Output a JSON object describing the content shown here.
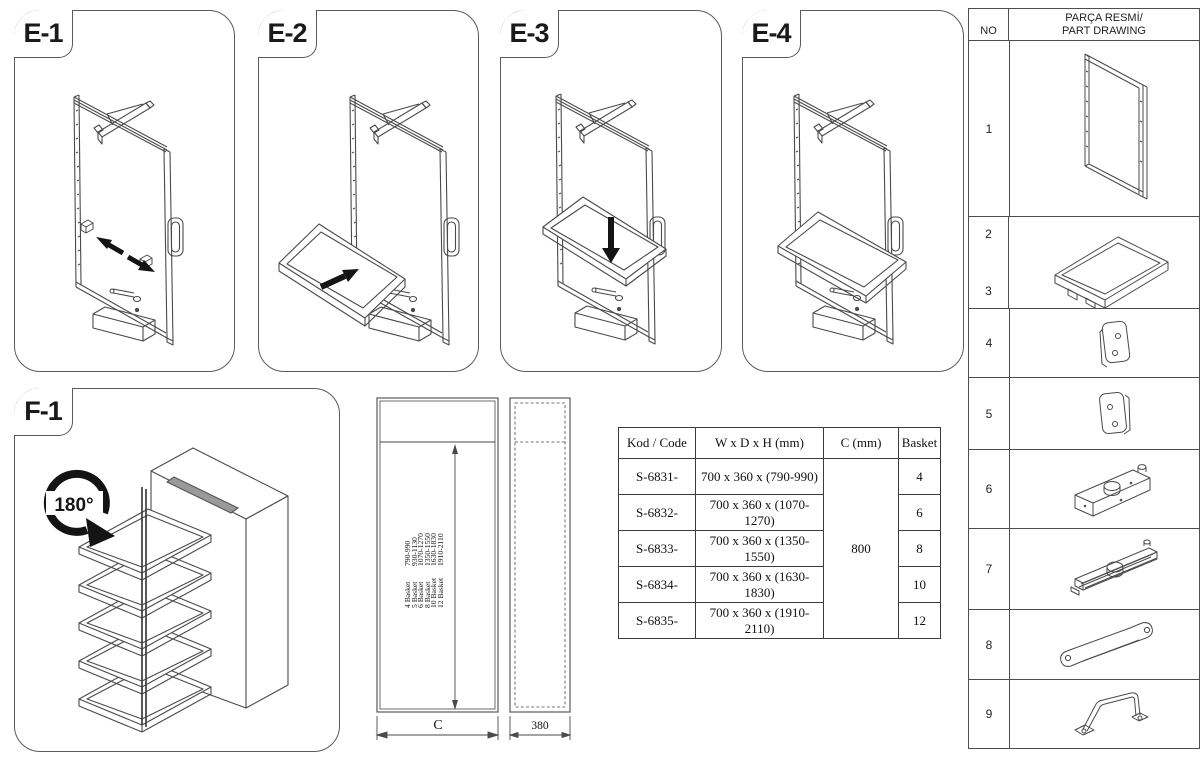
{
  "assembly_steps": {
    "e1_label": "E-1",
    "e2_label": "E-2",
    "e3_label": "E-3",
    "e4_label": "E-4"
  },
  "rotation_panel": {
    "label": "F-1",
    "rotation_text": "180°"
  },
  "dimension_drawing": {
    "height_options": [
      {
        "baskets": "4 Basket",
        "range": "790-990"
      },
      {
        "baskets": "5 Basket",
        "range": "930-1130"
      },
      {
        "baskets": "6 Basket",
        "range": "1070-1270"
      },
      {
        "baskets": "8 Basket",
        "range": "1350-1550"
      },
      {
        "baskets": "10 Basket",
        "range": "1630-1830"
      },
      {
        "baskets": "12 Basket",
        "range": "1910-2110"
      }
    ],
    "width_label": "C",
    "depth_label": "380"
  },
  "spec_table": {
    "headers": {
      "code": "Kod / Code",
      "dims": "W x D x H (mm)",
      "c": "C (mm)",
      "basket": "Basket"
    },
    "c_value": "800",
    "rows": [
      {
        "code": "S-6831-",
        "dims": "700 x 360 x (790-990)",
        "basket": "4"
      },
      {
        "code": "S-6832-",
        "dims": "700 x 360 x (1070-1270)",
        "basket": "6"
      },
      {
        "code": "S-6833-",
        "dims": "700 x 360 x (1350-1550)",
        "basket": "8"
      },
      {
        "code": "S-6834-",
        "dims": "700 x 360 x (1630-1830)",
        "basket": "10"
      },
      {
        "code": "S-6835-",
        "dims": "700 x 360 x (1910-2110)",
        "basket": "12"
      }
    ]
  },
  "parts_list": {
    "no_header": "NO",
    "drawing_header_line1": "PARÇA RESMİ/",
    "drawing_header_line2": "PART DRAWING",
    "rows": [
      {
        "no": "1",
        "part": "frame"
      },
      {
        "no": "2",
        "no_secondary": "3",
        "part": "basket-tray"
      },
      {
        "no": "4",
        "part": "mounting-plate-left"
      },
      {
        "no": "5",
        "part": "mounting-plate-right"
      },
      {
        "no": "6",
        "part": "pivot-housing"
      },
      {
        "no": "7",
        "part": "pivot-rail"
      },
      {
        "no": "8",
        "part": "connection-strap"
      },
      {
        "no": "9",
        "part": "support-handle"
      }
    ]
  },
  "colors": {
    "line": "#4a4a4a",
    "arrow_black": "#141414",
    "background": "#ffffff"
  }
}
